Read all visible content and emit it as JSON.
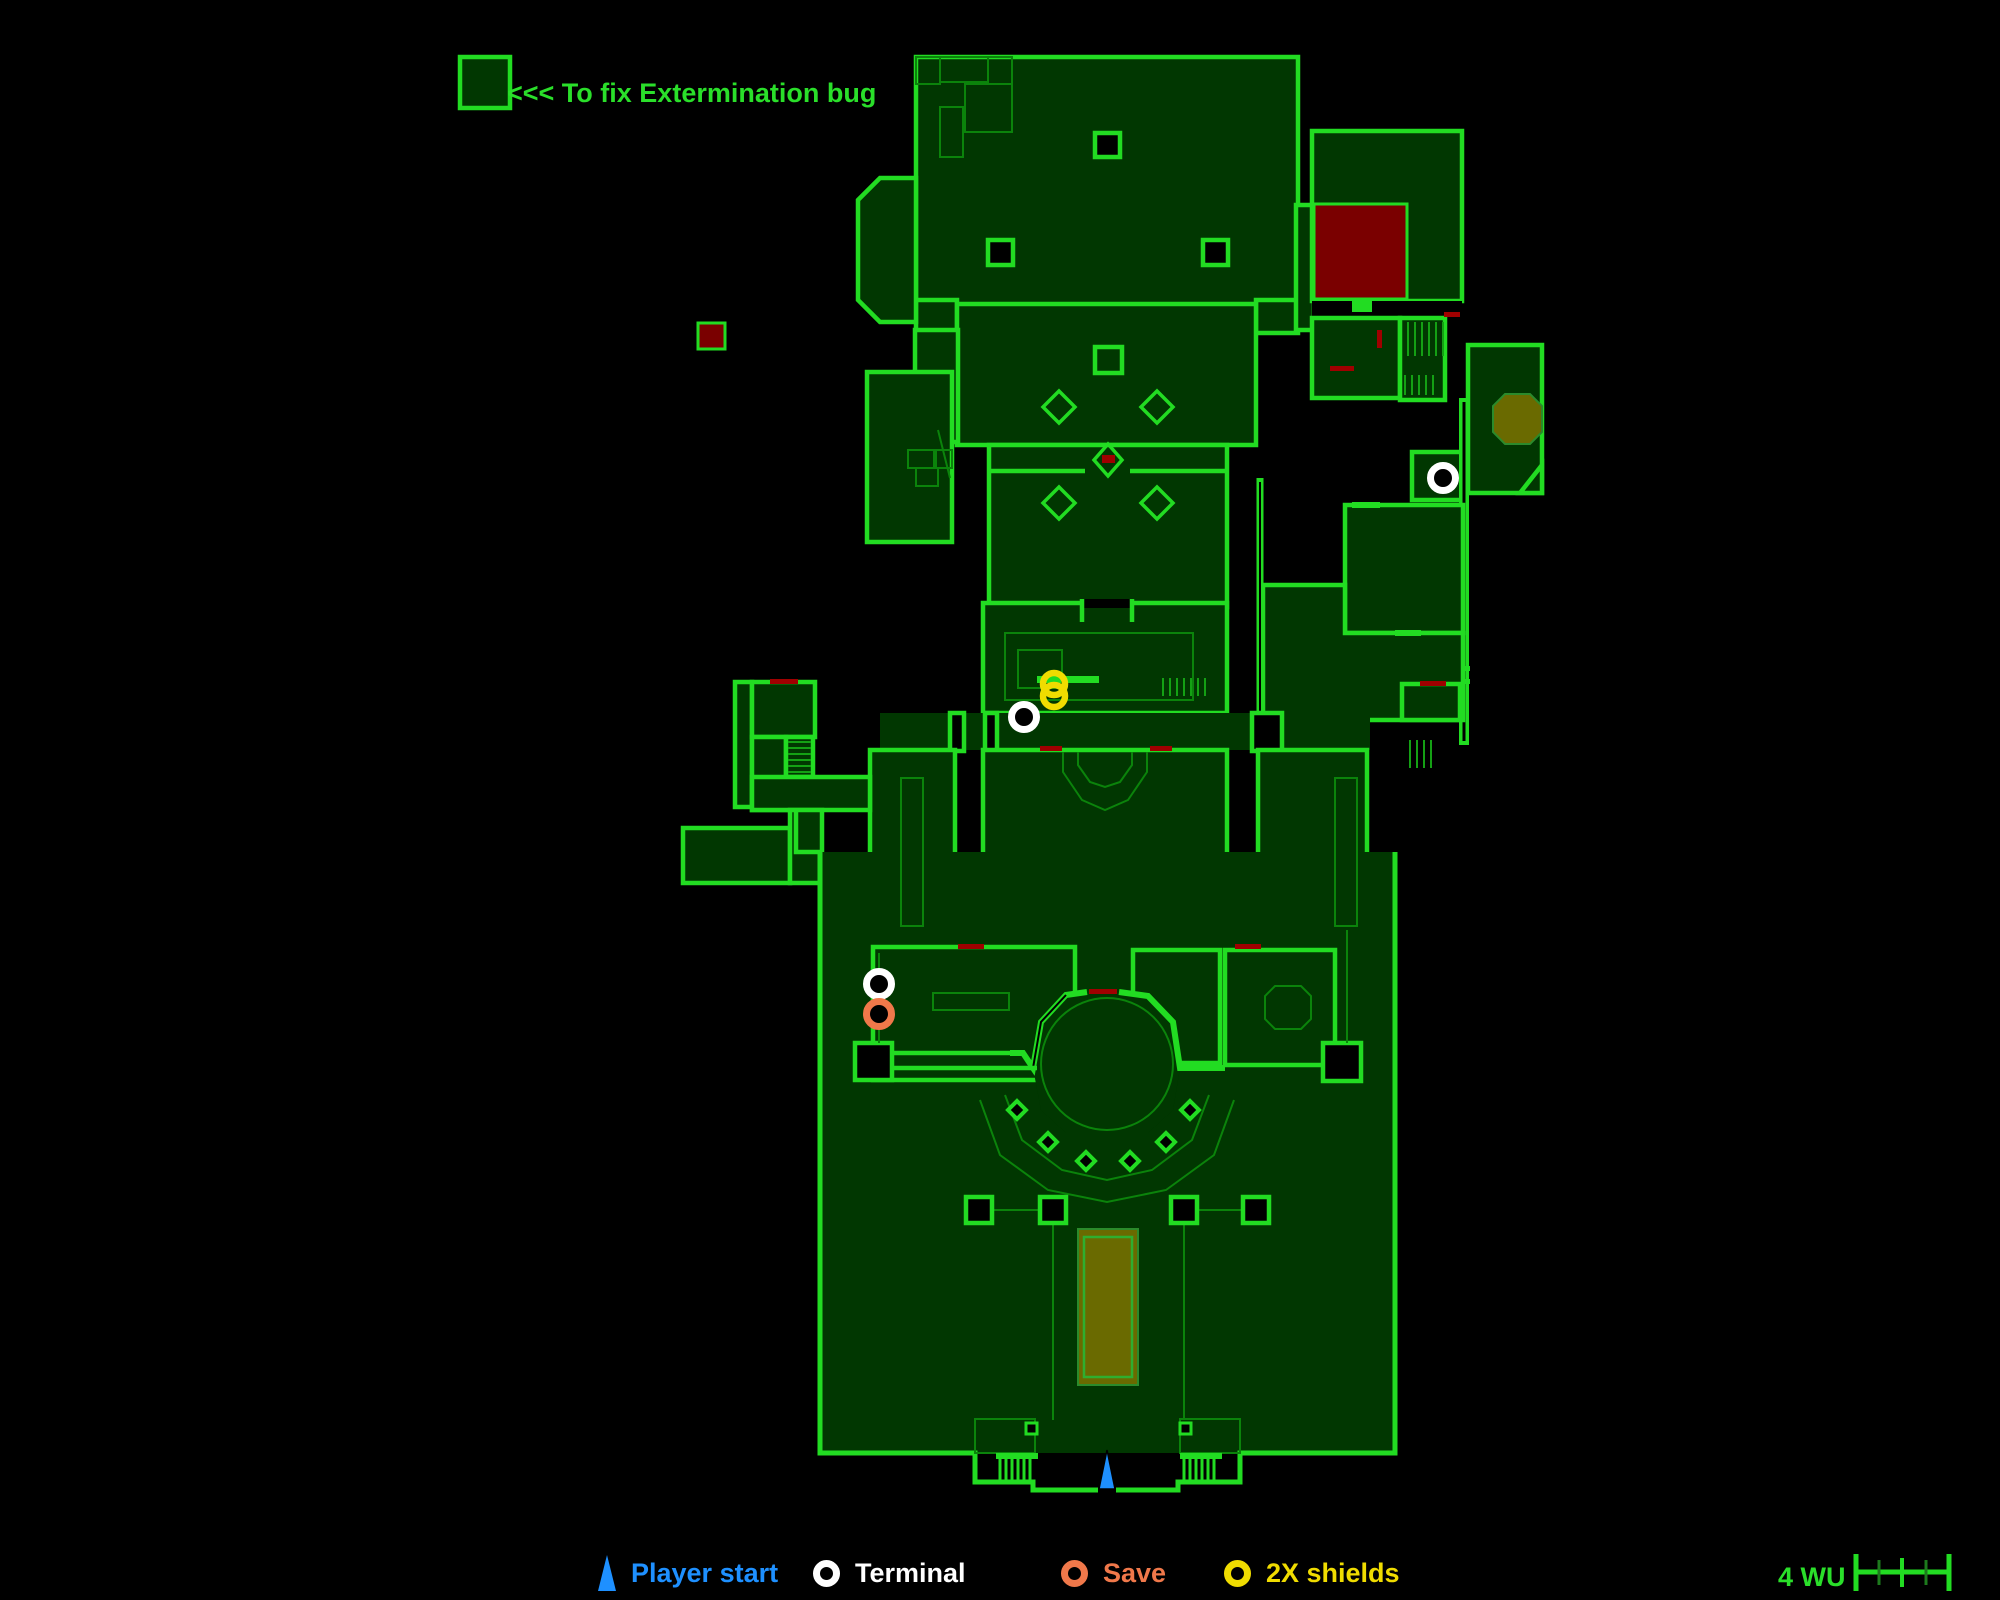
{
  "colors": {
    "bg": "#000000",
    "wall": "#22DC22",
    "fill": "#013701",
    "thin": "#0B830B",
    "thinbright": "#14A014",
    "textgreen": "#2ADF2A",
    "red": "#7A0000",
    "redsliver": "#A00000",
    "olive": "#6A6A00",
    "blue": "#1E90FF",
    "white": "#FFFFFF",
    "orange": "#F0784A",
    "yellow": "#F0DC00"
  },
  "annotation": {
    "text": "<<< To fix Extermination bug"
  },
  "legend": {
    "items": [
      {
        "id": "player-start",
        "label": "Player start",
        "color": "#1E90FF",
        "marker": "triangle"
      },
      {
        "id": "terminal",
        "label": "Terminal",
        "color": "#FFFFFF",
        "marker": "ring"
      },
      {
        "id": "save",
        "label": "Save",
        "color": "#F0784A",
        "marker": "ring"
      },
      {
        "id": "shields",
        "label": "2X shields",
        "color": "#F0DC00",
        "marker": "ring"
      }
    ]
  },
  "scale": {
    "label": "4 WU",
    "units": 4
  },
  "markers": {
    "terminals": [
      {
        "x": 1443,
        "y": 478
      },
      {
        "x": 1024,
        "y": 717
      },
      {
        "x": 879,
        "y": 984
      }
    ],
    "save": [
      {
        "x": 879,
        "y": 1014
      }
    ],
    "shields": [
      {
        "x": 1054,
        "y": 690
      }
    ],
    "player_start": {
      "x": 1107,
      "y": 1470
    }
  }
}
